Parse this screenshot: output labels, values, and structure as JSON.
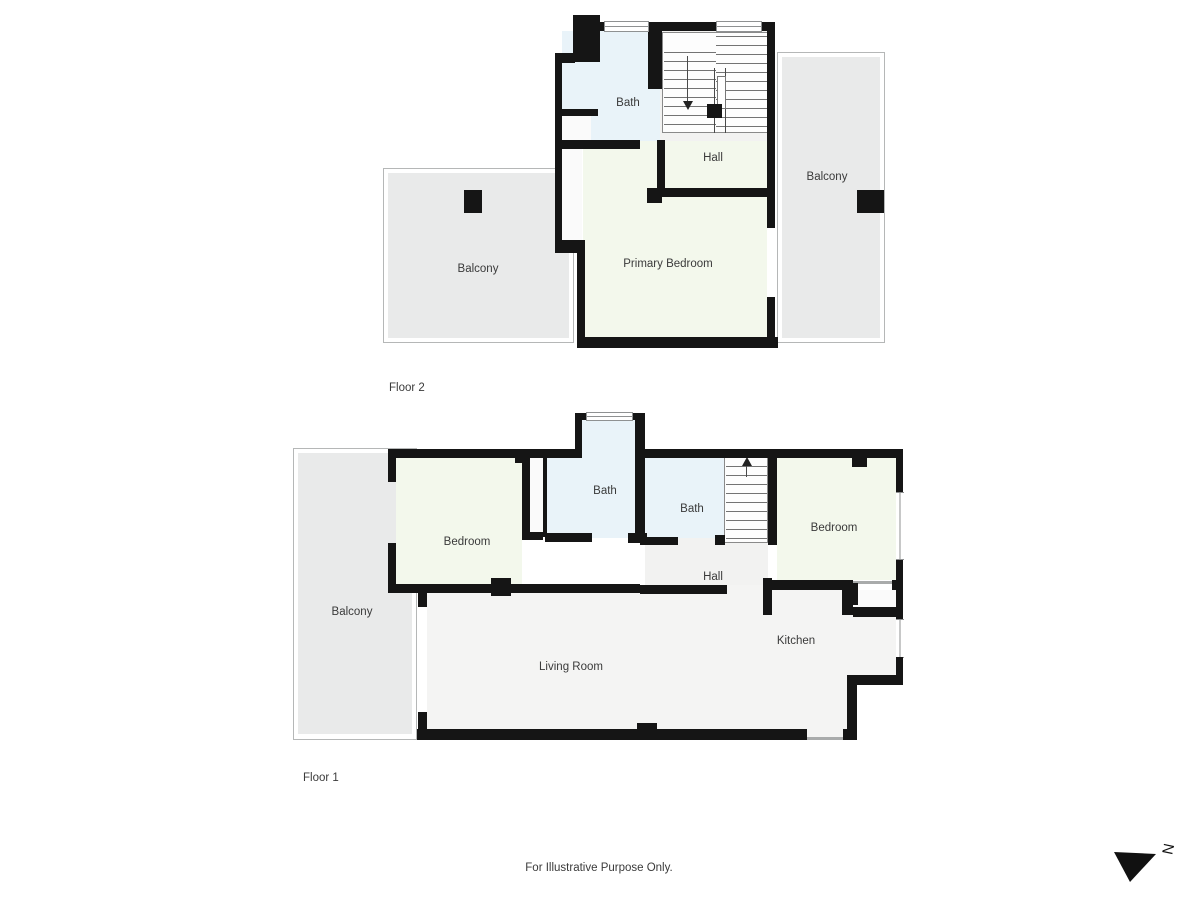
{
  "colors": {
    "wall": "#151515",
    "bath": "#e9f3f9",
    "bedroom": "#f3f8ec",
    "hall": "#f2f2f1",
    "living": "#f4f4f3",
    "balcony": "#e9eaea",
    "cavity": "#fafafa",
    "stair_bg": "#fdfdfd",
    "line": "#b5b7b7",
    "text": "#3a3a3a"
  },
  "floor2": {
    "label": "Floor 2",
    "rooms": {
      "bath": "Bath",
      "hall": "Hall",
      "balcony_left": "Balcony",
      "balcony_right": "Balcony",
      "primary_bedroom": "Primary Bedroom"
    }
  },
  "floor1": {
    "label": "Floor 1",
    "rooms": {
      "bath_top": "Bath",
      "bath_mid": "Bath",
      "bedroom_left": "Bedroom",
      "bedroom_right": "Bedroom",
      "hall": "Hall",
      "balcony": "Balcony",
      "kitchen": "Kitchen",
      "living_room": "Living Room"
    }
  },
  "footer": {
    "disclaimer": "For Illustrative Purpose Only."
  },
  "compass": {
    "letter": "N"
  }
}
